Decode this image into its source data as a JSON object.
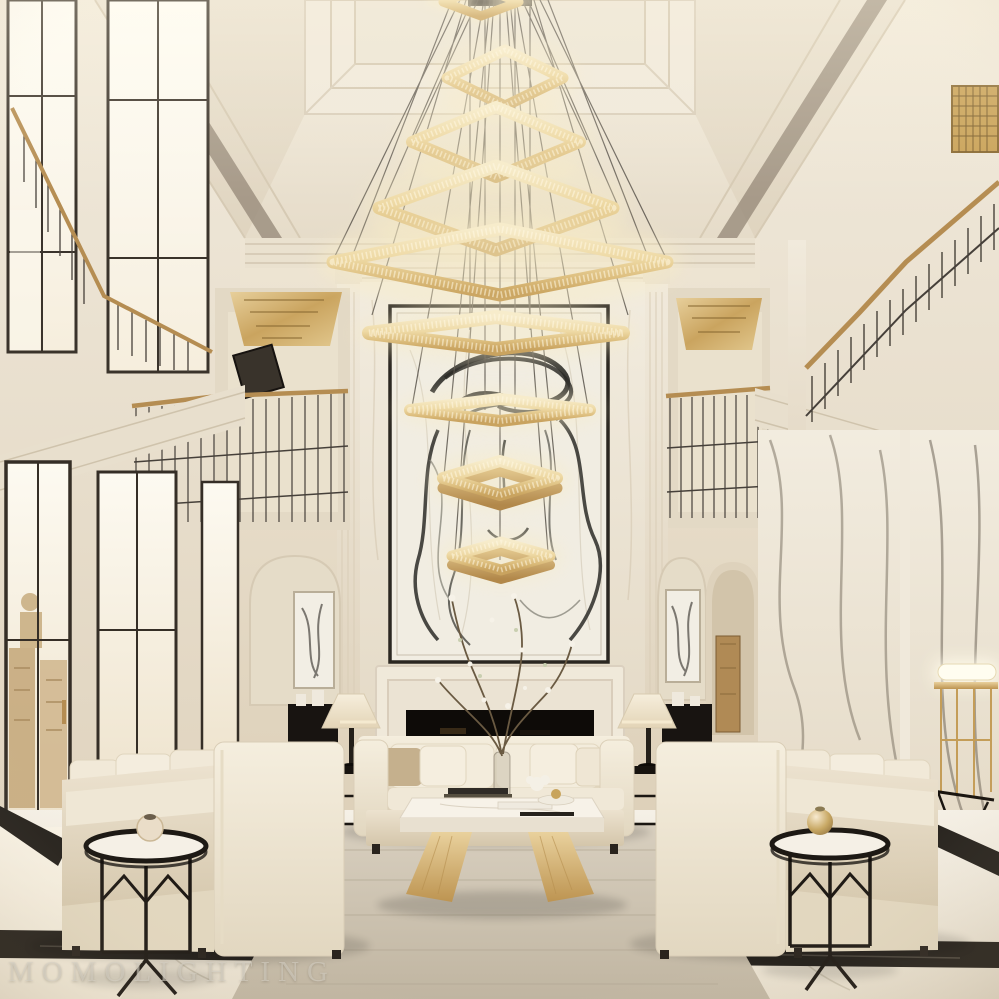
{
  "meta": {
    "type": "interior-photograph",
    "subject": "Luxury double-height neoclassical living room with a cascading tiered rectangular crystal chandelier",
    "width_px": 999,
    "height_px": 999
  },
  "watermark": {
    "text": "MOMOLIGHTING"
  },
  "palette": {
    "wall_cream": "#efe8da",
    "ceiling_cream": "#f2ecdf",
    "marble_white": "#f4efe6",
    "brass_gold": "#b58d52",
    "chandelier_gold": "#e9d3a0",
    "fabric_cream": "#f2ead9",
    "rug_taupe": "#cdc3b2",
    "floor_ivory": "#f2ede3",
    "black_marble": "#221e19",
    "ink_black": "#2b2a27",
    "fireplace_dark": "#0f0c09",
    "door_wood": "#b08a55"
  },
  "scene": {
    "objects": [
      "tiered-crystal-chandelier",
      "abstract-line-art-painting",
      "marble-fireplace",
      "center-sofa",
      "left-sofa",
      "right-sofa",
      "marble-coffee-table",
      "branch-centerpiece",
      "left-side-table",
      "right-side-table",
      "table-lamp-left",
      "table-lamp-right",
      "left-mezzanine-balcony",
      "right-mezzanine-balcony",
      "stair-railing",
      "tall-windows",
      "area-rug",
      "marble-floor",
      "gold-console",
      "arched-niche-left",
      "arched-niche-right",
      "corridor-door",
      "gilded-ceiling-panels"
    ]
  }
}
